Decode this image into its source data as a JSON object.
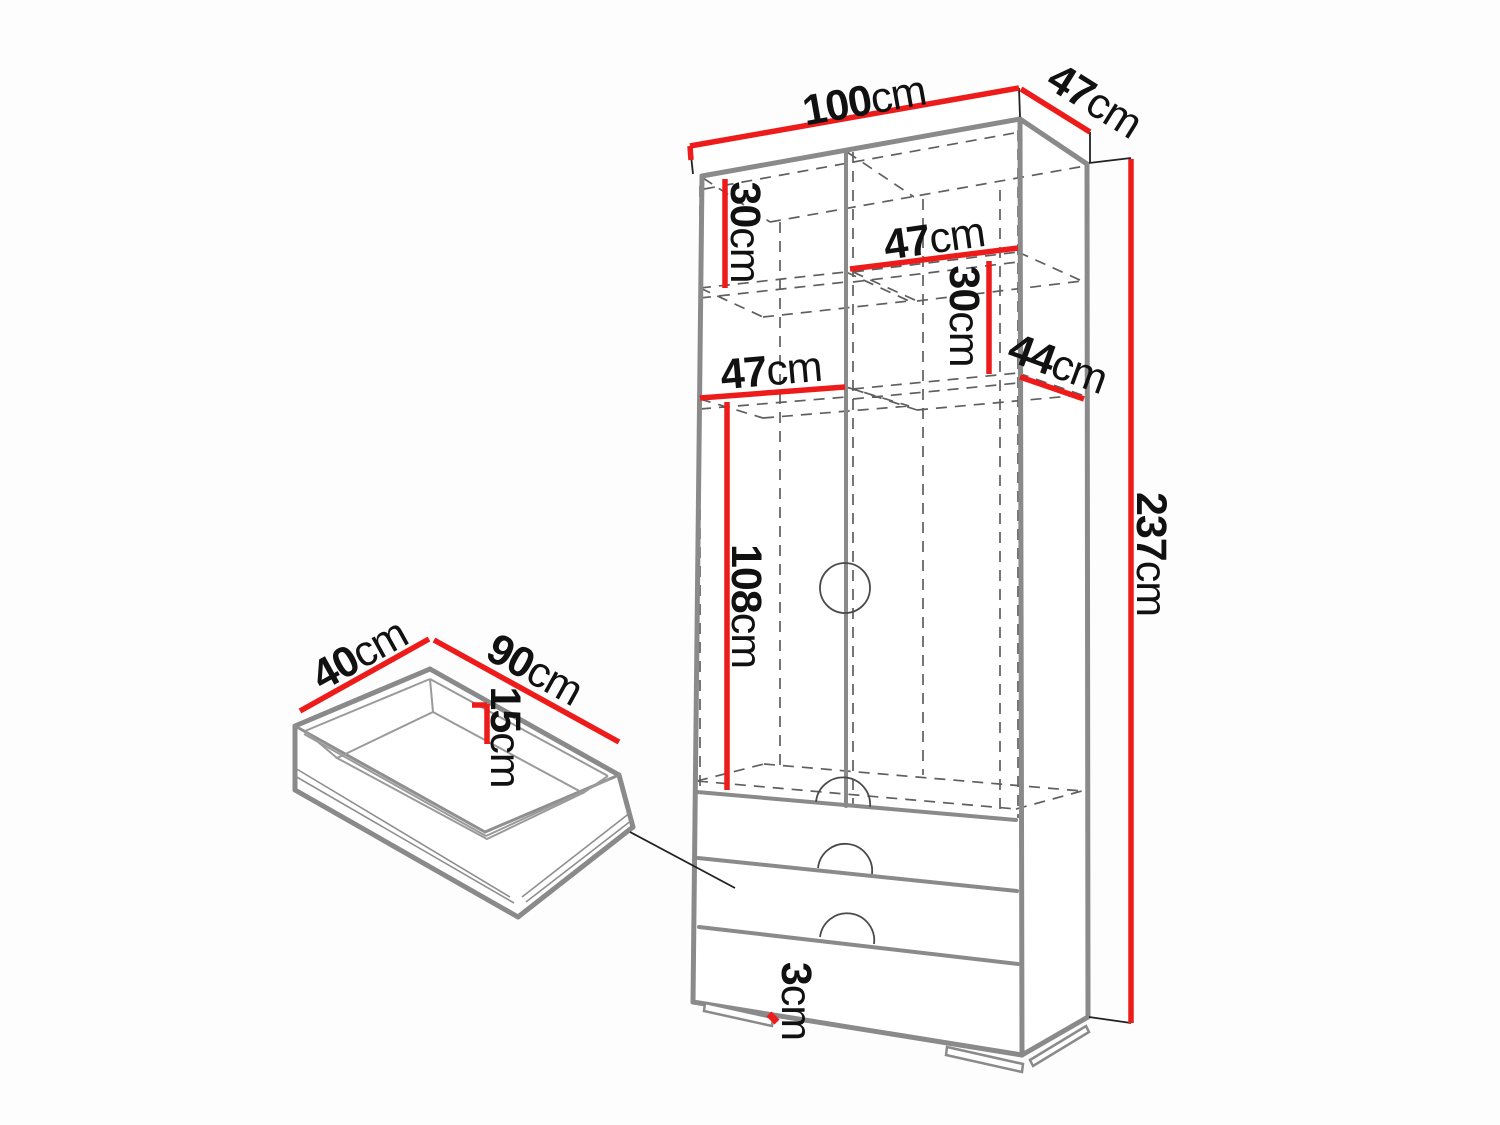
{
  "diagram_title": "Wardrobe dimension diagram",
  "wardrobe": {
    "width": {
      "value": "100",
      "unit": "cm"
    },
    "depth": {
      "value": "47",
      "unit": "cm"
    },
    "height": {
      "value": "237",
      "unit": "cm"
    },
    "top_section_height": {
      "value": "30",
      "unit": "cm"
    },
    "upper_shelf_width": {
      "value": "47",
      "unit": "cm"
    },
    "right_section_height": {
      "value": "30",
      "unit": "cm"
    },
    "shelf_depth": {
      "value": "44",
      "unit": "cm"
    },
    "left_shelf_width": {
      "value": "47",
      "unit": "cm"
    },
    "hanging_section_height": {
      "value": "108",
      "unit": "cm"
    },
    "plinth_height": {
      "value": "3",
      "unit": "cm"
    }
  },
  "drawer": {
    "depth": {
      "value": "40",
      "unit": "cm"
    },
    "width": {
      "value": "90",
      "unit": "cm"
    },
    "inner_height": {
      "value": "15",
      "unit": "cm"
    }
  },
  "colors": {
    "dimension_red": "#ee1b1b",
    "edge_gray": "#8a8a8a",
    "hidden_gray": "#5f5f5f",
    "text": "#111111",
    "background": "#fdfdfd"
  }
}
